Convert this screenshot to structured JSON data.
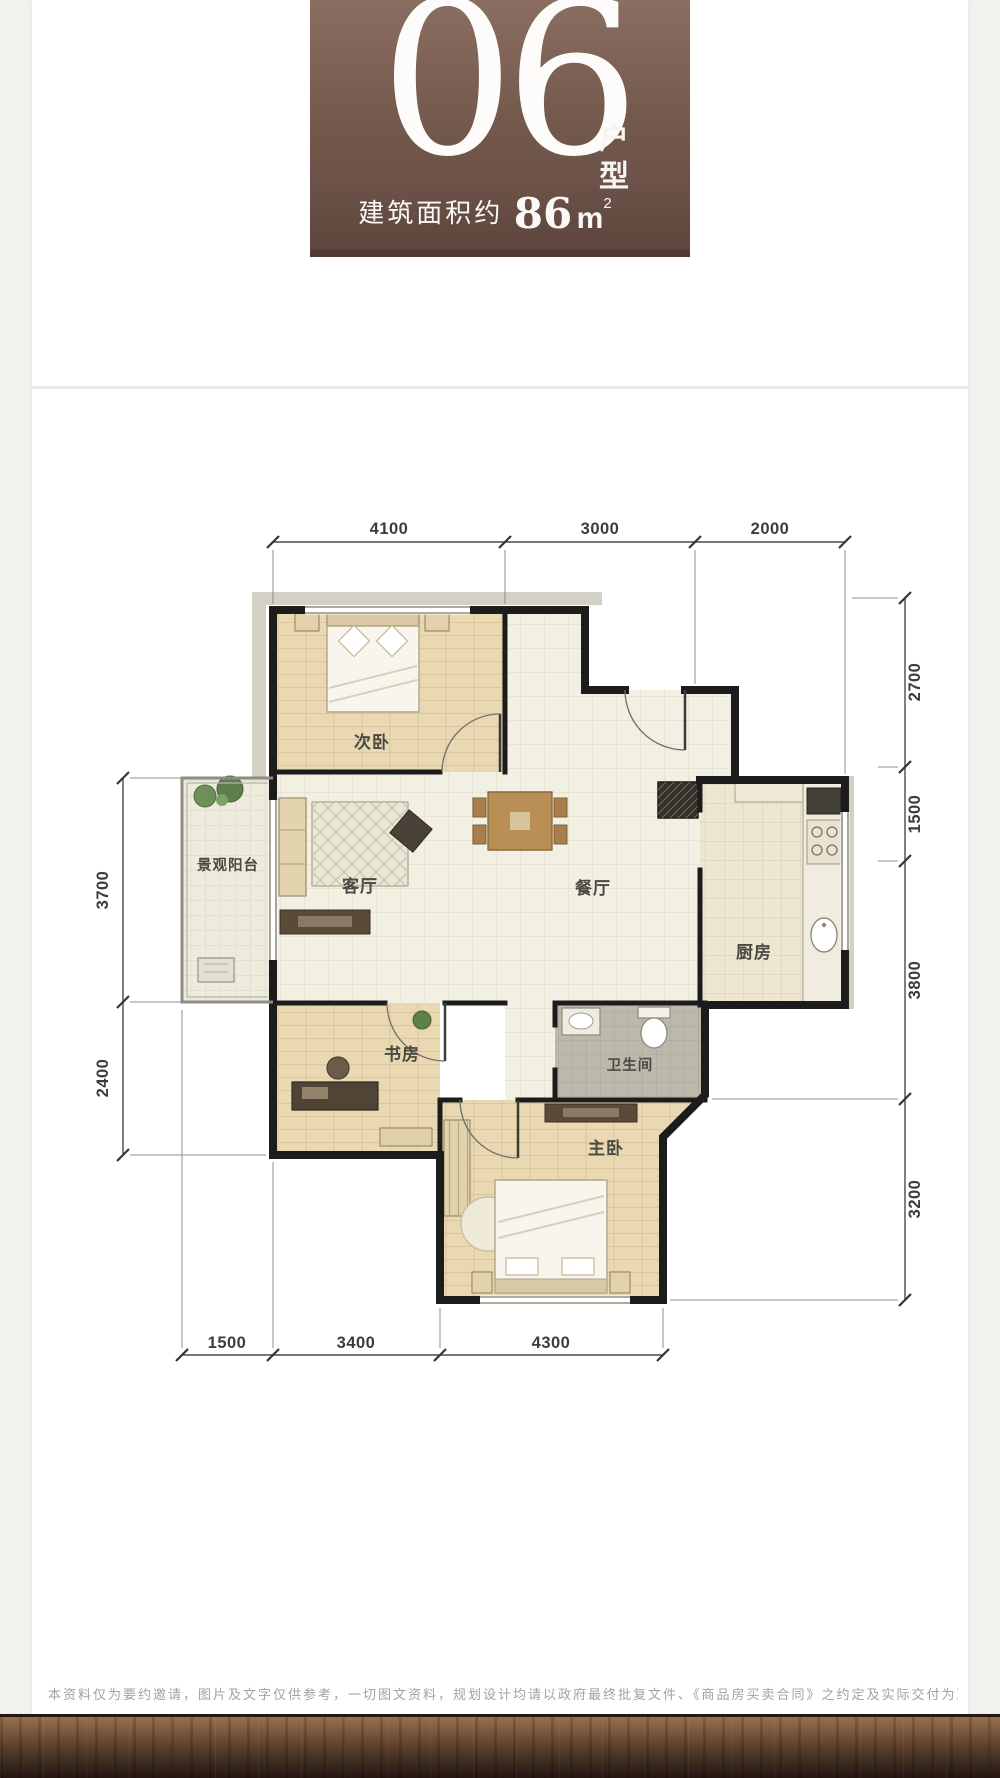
{
  "header": {
    "unit_number": "06",
    "unit_type_label": "户型",
    "area_prefix": "建筑面积约",
    "area_number": "86",
    "area_unit": "m",
    "area_exponent": "2"
  },
  "floor_plan": {
    "rooms": {
      "secondary_bedroom": "次卧",
      "balcony": "景观阳台",
      "living_room": "客厅",
      "dining_room": "餐厅",
      "kitchen": "厨房",
      "study": "书房",
      "bathroom": "卫生间",
      "master_bedroom": "主卧"
    },
    "dimensions": {
      "top": [
        "4100",
        "3000",
        "2000"
      ],
      "right": [
        "2700",
        "1500",
        "3800",
        "3200"
      ],
      "left": [
        "3700",
        "2400"
      ],
      "bottom": [
        "1500",
        "3400",
        "4300"
      ]
    }
  },
  "footer": {
    "disclaimer": "本资料仅为要约邀请，图片及文字仅供参考，一切图文资料，规划设计均请以政府最终批复文件、《商品房买卖合同》之约定及实际交付为准。"
  },
  "colors": {
    "header_brown": "#6e544a",
    "wall_black": "#1c1c1c",
    "wood_floor": "#e9d8b2",
    "tile_floor": "#f2efe3",
    "footer_wood": "#3c2a1c"
  }
}
